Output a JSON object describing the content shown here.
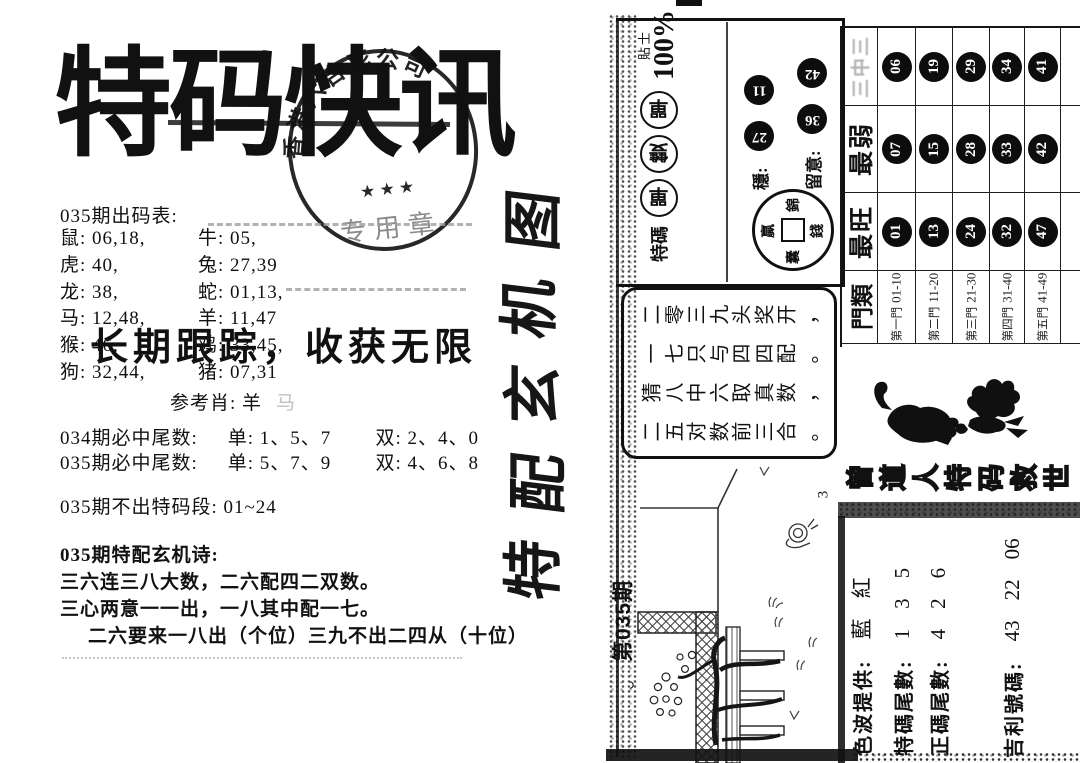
{
  "left": {
    "title": "特码快讯",
    "stamp": {
      "arc_text": "香港六合彩公司",
      "stars": "★ ★ ★",
      "center_text": "专用章"
    },
    "subtitle": "长期跟踪，收获无限",
    "codes_heading": "035期出码表:",
    "codes_rows": [
      [
        "鼠: 06,18,",
        "牛: 05,"
      ],
      [
        "虎: 40,",
        "兔: 27,39"
      ],
      [
        "龙: 38,",
        "蛇: 01,13,"
      ],
      [
        "马: 12,48,",
        "羊: 11,47"
      ],
      [
        "猴: 46,",
        "鸡: 33,45,"
      ],
      [
        "狗: 32,44,",
        "猪: 07,31"
      ]
    ],
    "reference": "参考肖: 羊",
    "reference_ghost": "马",
    "tails": [
      {
        "label": "034期必中尾数:",
        "odd": "单: 1、5、7",
        "even": "双: 2、4、0"
      },
      {
        "label": "035期必中尾数:",
        "odd": "单: 5、7、9",
        "even": "双: 4、6、8"
      }
    ],
    "no_segment": "035期不出特码段: 01~24",
    "poem_heading": "035期特配玄机诗:",
    "poem_lines": [
      "三六连三八大数，二六配四二双数。",
      "三心两意一一出，一八其中配一七。",
      "二六要来一八出（个位）三九不出二四从（十位）"
    ]
  },
  "right": {
    "tip": {
      "label": "特碼",
      "circle_chars": [
        "單",
        "雙",
        "單"
      ],
      "tip_word": "貼士",
      "percent": "100%",
      "stable_label": "穩:",
      "stable_nums": [
        "27",
        "11"
      ],
      "note_label": "留意:",
      "note_nums": [
        "36",
        "42"
      ],
      "coin": {
        "top": "錦",
        "left": "贏",
        "right": "錢",
        "bottom": "囊"
      }
    },
    "table": {
      "headers": {
        "row0": "三中三",
        "row1": "最弱",
        "row2": "最旺",
        "row3": "門類"
      },
      "columns": [
        {
          "san": "06",
          "weak": "07",
          "hot": "01",
          "gate": "第一門",
          "range": "01-10"
        },
        {
          "san": "19",
          "weak": "15",
          "hot": "13",
          "gate": "第二門",
          "range": "11-20"
        },
        {
          "san": "29",
          "weak": "28",
          "hot": "24",
          "gate": "第三門",
          "range": "21-30"
        },
        {
          "san": "34",
          "weak": "33",
          "hot": "32",
          "gate": "第四門",
          "range": "31-40"
        },
        {
          "san": "41",
          "weak": "42",
          "hot": "47",
          "gate": "第五門",
          "range": "41-49"
        }
      ]
    },
    "poem_box": [
      "二零三九头奖开，",
      "一七只与四四配。",
      "猜八中六取真数，",
      "二五对数前三合。"
    ],
    "brush_text": "特配玄机图",
    "issue": "第035期",
    "outlined_text": "曾道人特码救世",
    "figure_mark": "3",
    "info": [
      {
        "label": "色波提供:",
        "v1": "藍",
        "v2": "紅",
        "v3": ""
      },
      {
        "label": "特碼尾數:",
        "v1": "1",
        "v2": "3",
        "v3": "5"
      },
      {
        "label": "正碼尾數:",
        "v1": "4",
        "v2": "2",
        "v3": "6"
      },
      {
        "label": "吉利號碼:",
        "v1": "43",
        "v2": "22",
        "v3": "06"
      }
    ]
  }
}
